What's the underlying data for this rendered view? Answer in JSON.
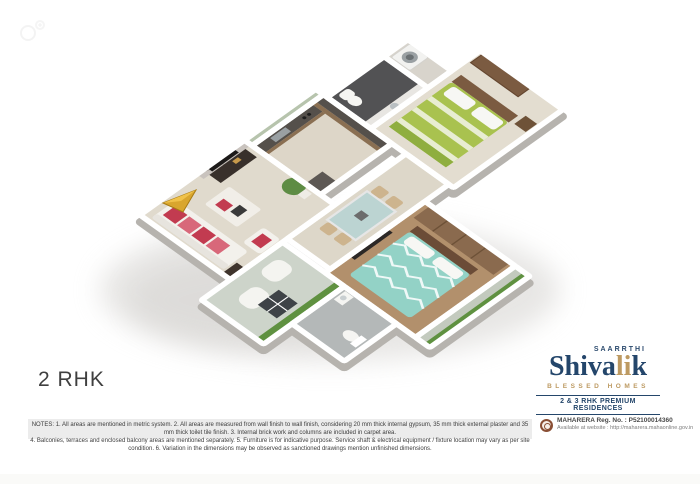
{
  "page": {
    "type_label": "2 RHK"
  },
  "brand": {
    "parent": "SAARRTHI",
    "wordmark": {
      "part1": "Shiva",
      "part2": "li",
      "part3": "k"
    },
    "tagline": "BLESSED HOMES",
    "banner": "2 & 3 RHK PREMIUM RESIDENCES",
    "colors": {
      "navy": "#24466b",
      "gold": "#bd9a62"
    }
  },
  "notes": {
    "line1": "NOTES: 1. All areas are mentioned in metric system.  2. All areas are measured from wall finish to wall finish, considering 20 mm thick internal gypsum, 35 mm thick external plaster and 35 mm thick toilet tile finish.  3. Internal brick work and columns are included in carpet area.",
    "line2": "4. Balconies, terraces and enclosed balcony areas are mentioned separately.  5. Furniture is for indicative purpose. Service shaft & electrical equipment / fixture location may vary as per site condition.  6. Variation in the dimensions may be observed as sanctioned drawings mention unfinished dimensions."
  },
  "rera": {
    "registration": "MAHARERA Reg. No. : P52100014360",
    "website": "Available at website : http://maharera.mahaonline.gov.in"
  },
  "floorplan": {
    "view": "isometric-3d-render",
    "north_arrow_color": "#d9a62e",
    "colors": {
      "floor_beige": "#e0dacd",
      "bedroom1_bed_green": "#a9c24f",
      "bedroom2_bed_teal": "#93d2c6",
      "bedroom2_floor_wood": "#b2906c",
      "bathroom_dark_tile": "#525254",
      "kitchen_counter": "#55504b",
      "sofa_cushion_red": "#c23b50",
      "terrace_grass": "#5f9140",
      "wall_white": "#ffffff"
    }
  }
}
